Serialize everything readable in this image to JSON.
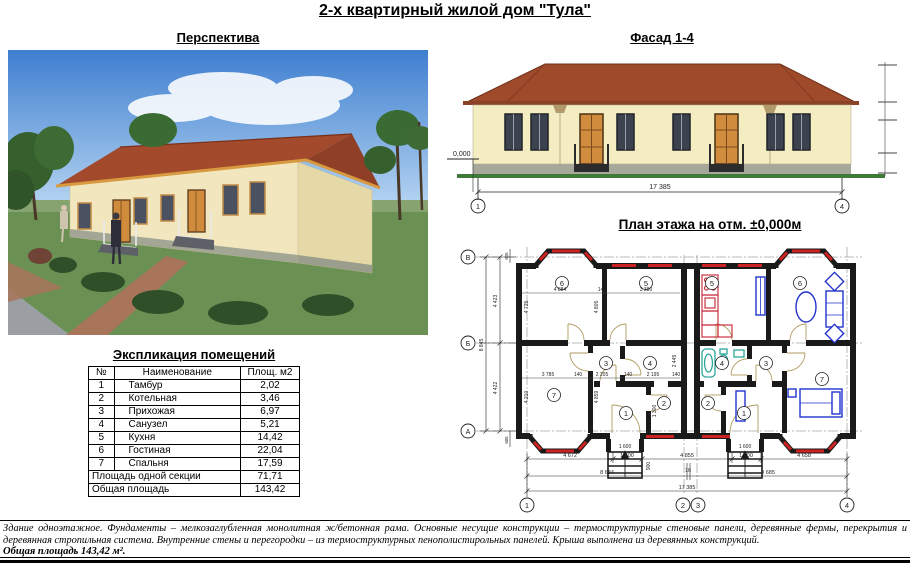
{
  "page": {
    "title": "2-х квартирный жилой дом \"Тула\"",
    "description": "Здание одноэтажное. Фундаменты – мелкозаглубленная монолитная ж/бетонная рама. Основные несущие конструкции – термоструктурные стеновые панели, деревянные фермы, перекрытия и деревянная стропильная система.  Внутренние стены и перегородки – из термоструктурных пенополистирольных панелей. Крыша выполнена из деревянных конструкций.",
    "total_area_note": "Общая площадь 143,42 м²."
  },
  "perspective": {
    "heading": "Перспектива"
  },
  "facade": {
    "heading": "Фасад 1-4",
    "level_mark": "0,000",
    "width_dim": "17 385",
    "axis_first": "1",
    "axis_last": "4"
  },
  "plan": {
    "heading": "План этажа на отм. ±0,000м",
    "axes_bottom": [
      "1",
      "2",
      "3",
      "4"
    ],
    "axes_left": [
      "В",
      "Б",
      "А"
    ],
    "rooms_left_unit": {
      "living": "6",
      "kitchen": "5",
      "bedroom": "7",
      "hall": "3",
      "bath": "4",
      "tambour": "1",
      "boiler": "2"
    },
    "rooms_right_unit": {
      "kitchen": "5",
      "living": "6",
      "bath": "4",
      "hall": "3",
      "tambour": "1",
      "boiler": "2",
      "bedroom": "7"
    },
    "dims": {
      "bottom_row1": [
        "4 672",
        "1 600",
        "4 855",
        "1 600",
        "4 658"
      ],
      "bottom_row2": [
        "8 684",
        "16",
        "9 685"
      ],
      "bottom_total": "17 385",
      "left_segments": [
        "4 423",
        "4 422"
      ],
      "left_total": "8 845",
      "left_edge": [
        "605",
        "605"
      ],
      "top_inner": [
        "4 884",
        "140",
        "3 380"
      ],
      "mid_inner": [
        "3 785",
        "140",
        "2 205",
        "140",
        "2 195",
        "140"
      ],
      "vert_inner": [
        "4 725",
        "4 805",
        "4 210",
        "4 859",
        "2 445"
      ],
      "entry": [
        "1 600",
        "1 600",
        "1 300",
        "900"
      ]
    }
  },
  "schedule": {
    "heading": "Экспликация помещений",
    "columns": [
      "№",
      "Наименование",
      "Площ. м2"
    ],
    "rows": [
      [
        "1",
        "Тамбур",
        "2,02"
      ],
      [
        "2",
        "Котельная",
        "3,46"
      ],
      [
        "3",
        "Прихожая",
        "6,97"
      ],
      [
        "4",
        "Санузел",
        "5,21"
      ],
      [
        "5",
        "Кухня",
        "14,42"
      ],
      [
        "6",
        "Гостиная",
        "22,04"
      ],
      [
        "7",
        "Спальня",
        "17,59"
      ]
    ],
    "footer": [
      [
        "Площадь одной секции",
        "71,71"
      ],
      [
        "Общая площадь",
        "143,42"
      ]
    ]
  },
  "colors": {
    "roof": "#a34a2c",
    "wall": "#f1e6bd",
    "window_red": "#cc2222",
    "furniture_blue": "#2233cc",
    "sanitary_teal": "#2aa79a",
    "kitchen_red": "#cc3344",
    "ground_green": "#3f7a38"
  }
}
